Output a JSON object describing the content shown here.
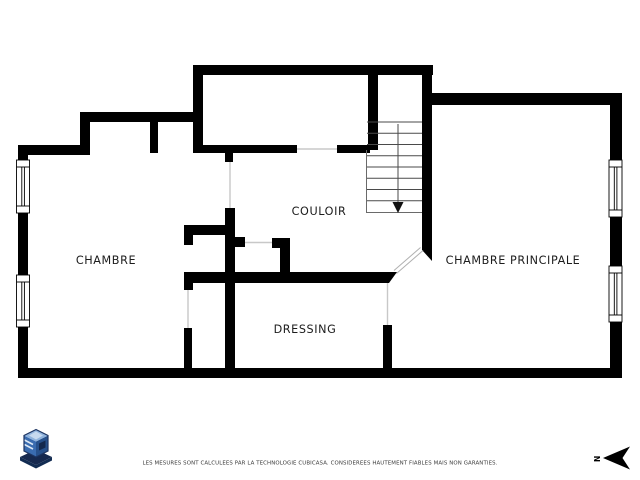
{
  "page": {
    "type": "floor-plan",
    "background": "#ffffff"
  },
  "rooms": [
    {
      "name": "chambre",
      "label": "CHAMBRE"
    },
    {
      "name": "couloir",
      "label": "COULOIR"
    },
    {
      "name": "dressing",
      "label": "DRESSING"
    },
    {
      "name": "chambre-principale",
      "label": "CHAMBRE PRINCIPALE"
    }
  ],
  "stairs": {
    "treads": 8,
    "direction_arrow": "down"
  },
  "compass": {
    "north_label": "N"
  },
  "footer": {
    "disclaimer": "LES MESURES SONT CALCULEES PAR LA TECHNOLOGIE CUBICASA. CONSIDEREES HAUTEMENT FIABLES MAIS NON GARANTIES."
  },
  "colors": {
    "wall": "#000000",
    "door_opening": "#c8c8c8",
    "logo_top": "#8fb3dd",
    "logo_left": "#3a6cb0",
    "logo_right": "#27518c",
    "logo_base": "#16294f"
  }
}
